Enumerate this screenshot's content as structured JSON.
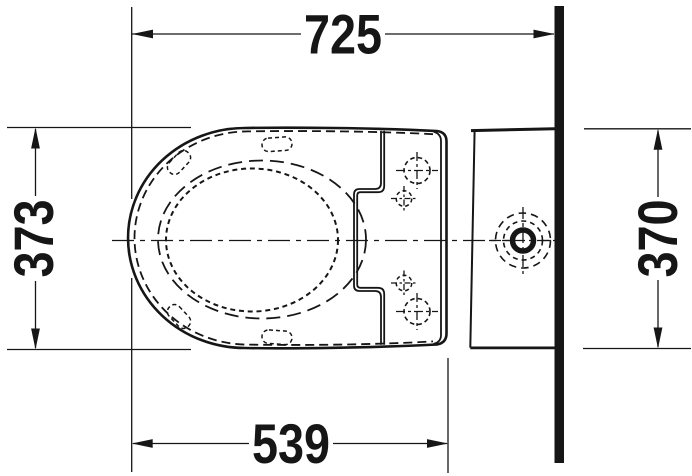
{
  "dimensions": {
    "top": "725",
    "left": "373",
    "right": "370",
    "bottom": "539"
  },
  "colors": {
    "ink": "#161616",
    "background": "#ffffff"
  }
}
